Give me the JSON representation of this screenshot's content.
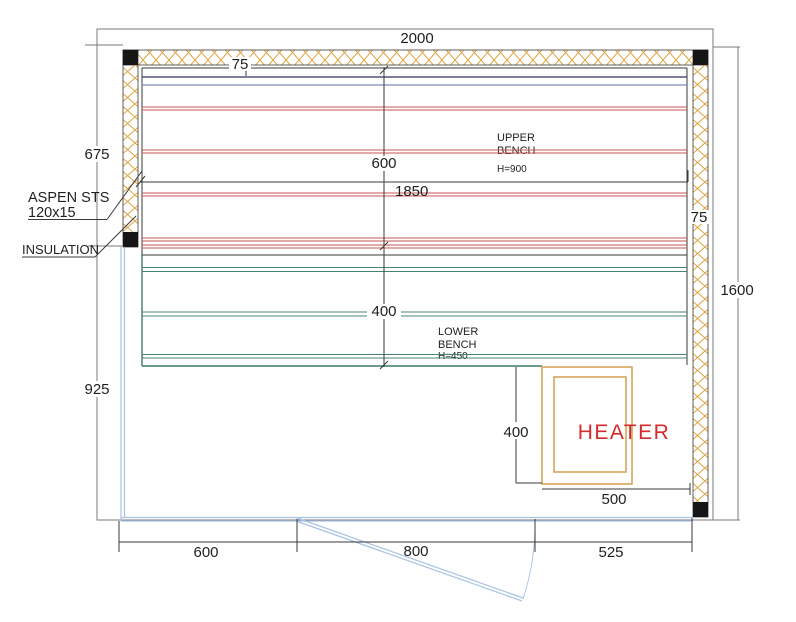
{
  "drawing": {
    "type": "sauna-floor-plan"
  },
  "dimensions": {
    "overall_width": "2000",
    "overall_height": "1600",
    "left_wall_upper": "675",
    "left_wall_lower": "925",
    "wall_thickness_top": "75",
    "wall_thickness_right": "75",
    "bench_length": "1850",
    "upper_bench_depth": "600",
    "lower_bench_depth": "400",
    "bottom_left_segment": "600",
    "door_opening": "800",
    "bottom_right_segment": "525",
    "heater_guard_depth": "400",
    "heater_width": "500"
  },
  "labels": {
    "cladding_line1": "ASPEN STS",
    "cladding_line2": "120x15",
    "insulation": "INSULATION",
    "upper_bench_line1": "UPPER",
    "upper_bench_line2": "BENCH",
    "upper_bench_height": "H=900",
    "lower_bench_line1": "LOWER",
    "lower_bench_line2": "BENCH",
    "lower_bench_height": "H=450",
    "heater": "HEATER"
  },
  "colors": {
    "wall_hatch": "#dfa23e",
    "bench_red": "#c85555",
    "bench_green": "#4a8374",
    "backrest_navy": "#2e3360",
    "backrest_blue": "#7e89bc",
    "glass_blue": "#a8c2e6",
    "heater_outline": "#d09a42",
    "heater_text": "#d62b2b",
    "drawing_line": "#3a3a3a",
    "dimension_line": "#7a7a7a"
  }
}
